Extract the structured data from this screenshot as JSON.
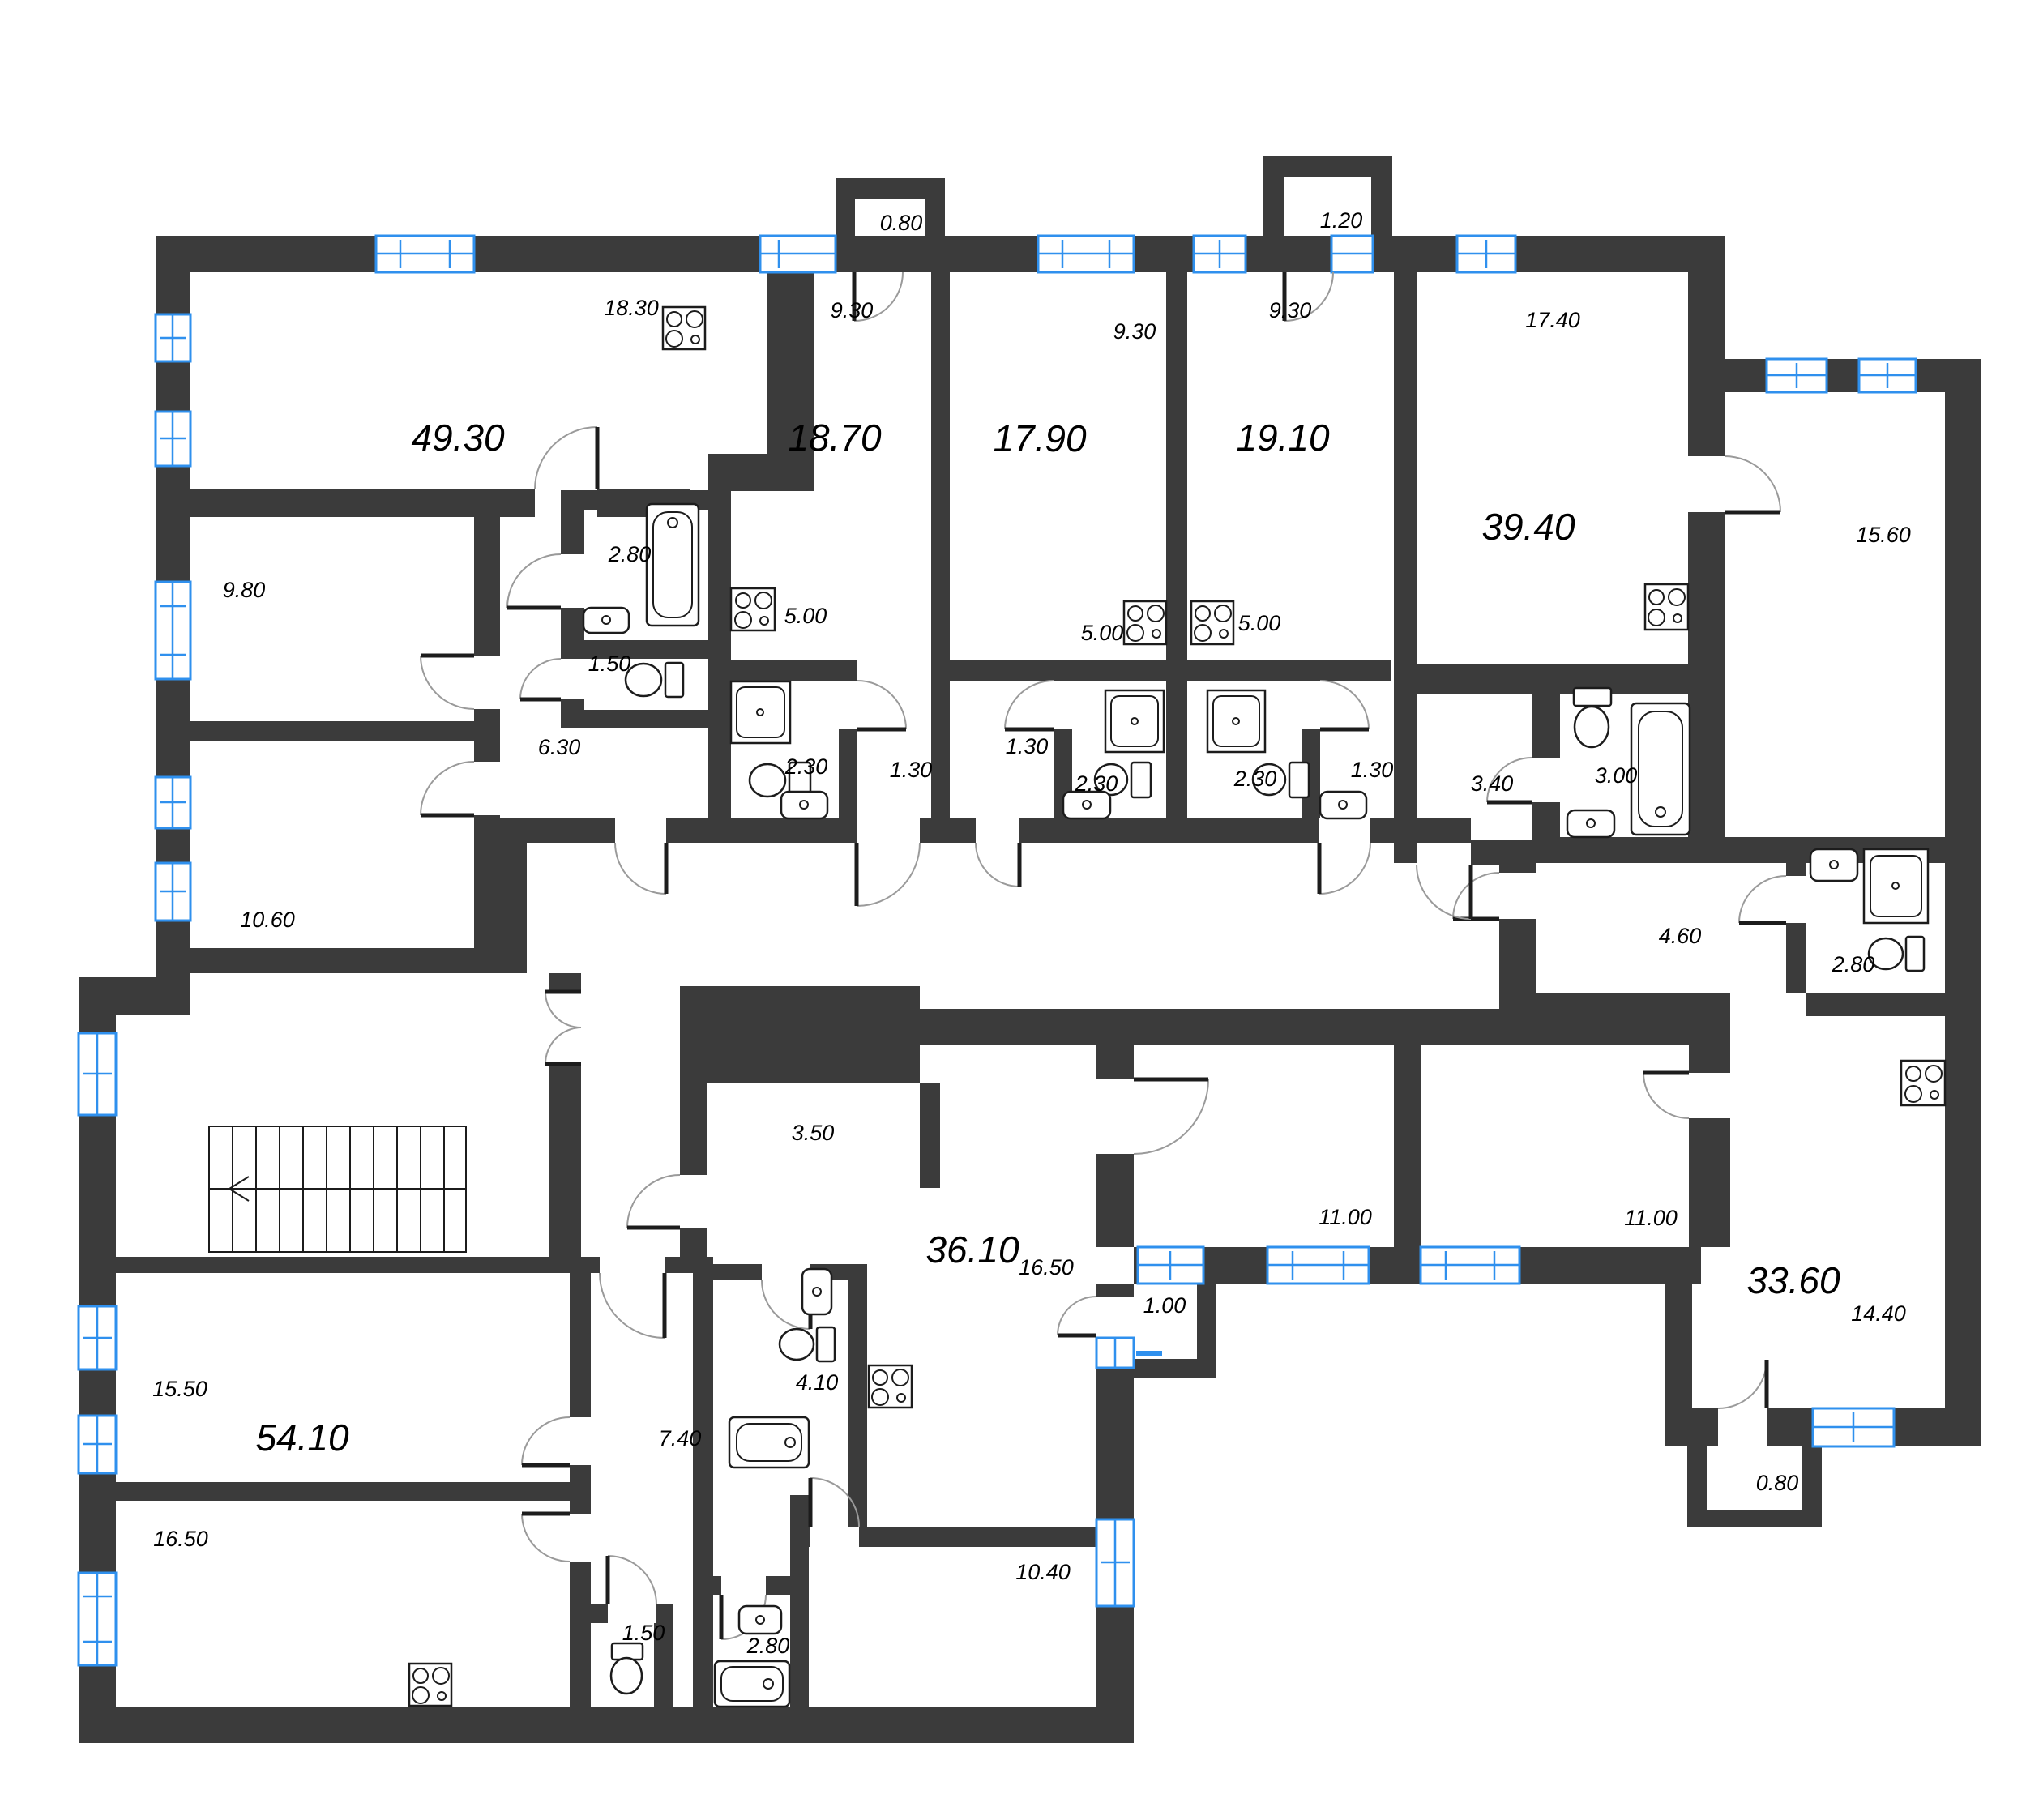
{
  "plan": {
    "type": "residential-floor-plan",
    "wall_color": "#3b3b3b",
    "window_color": "#2f90ee",
    "background_color": "#ffffff"
  },
  "apartments": [
    {
      "area": "49.30"
    },
    {
      "area": "18.70"
    },
    {
      "area": "17.90"
    },
    {
      "area": "19.10"
    },
    {
      "area": "39.40"
    },
    {
      "area": "54.10"
    },
    {
      "area": "36.10"
    },
    {
      "area": "33.60"
    }
  ],
  "rooms": [
    {
      "area": "18.30"
    },
    {
      "area": "9.30"
    },
    {
      "area": "9.30"
    },
    {
      "area": "9.30"
    },
    {
      "area": "0.80"
    },
    {
      "area": "1.20"
    },
    {
      "area": "17.40"
    },
    {
      "area": "15.60"
    },
    {
      "area": "9.80"
    },
    {
      "area": "2.80"
    },
    {
      "area": "5.00"
    },
    {
      "area": "5.00"
    },
    {
      "area": "5.00"
    },
    {
      "area": "1.50"
    },
    {
      "area": "6.30"
    },
    {
      "area": "10.60"
    },
    {
      "area": "2.30"
    },
    {
      "area": "2.30"
    },
    {
      "area": "2.30"
    },
    {
      "area": "1.30"
    },
    {
      "area": "1.30"
    },
    {
      "area": "1.30"
    },
    {
      "area": "3.40"
    },
    {
      "area": "3.00"
    },
    {
      "area": "4.60"
    },
    {
      "area": "2.80"
    },
    {
      "area": "3.50"
    },
    {
      "area": "16.50"
    },
    {
      "area": "11.00"
    },
    {
      "area": "11.00"
    },
    {
      "area": "1.00"
    },
    {
      "area": "4.10"
    },
    {
      "area": "15.50"
    },
    {
      "area": "16.50"
    },
    {
      "area": "7.40"
    },
    {
      "area": "1.50"
    },
    {
      "area": "2.80"
    },
    {
      "area": "10.40"
    },
    {
      "area": "14.40"
    },
    {
      "area": "0.80"
    }
  ]
}
